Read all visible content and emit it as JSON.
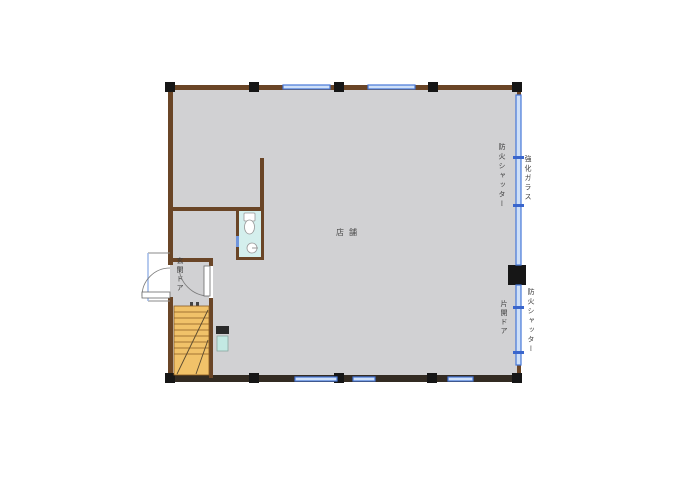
{
  "title": "floor-plan",
  "labels": {
    "room": "店舗",
    "entrance_door": "玄関ドア",
    "fire_shutter_upper": "防火シャッター",
    "tempered_glass": "強化ガラス",
    "single_swing_door": "片開ドア",
    "fire_shutter_lower": "防火シャッター"
  },
  "colors": {
    "floor": "#d1d1d3",
    "wall_brown": "#6a4526",
    "wall_dark": "#332b22",
    "column_black": "#161616",
    "window_blue": "#4677d8",
    "window_fill": "#cfe0f8",
    "window_tick": "#3a66cc",
    "stairs_fill": "#f1c269",
    "stairs_line": "#8a5a20",
    "toilet_floor": "#d4efed",
    "utility_teal": "#c3e9e3",
    "label_text": "#3c3c3c"
  }
}
